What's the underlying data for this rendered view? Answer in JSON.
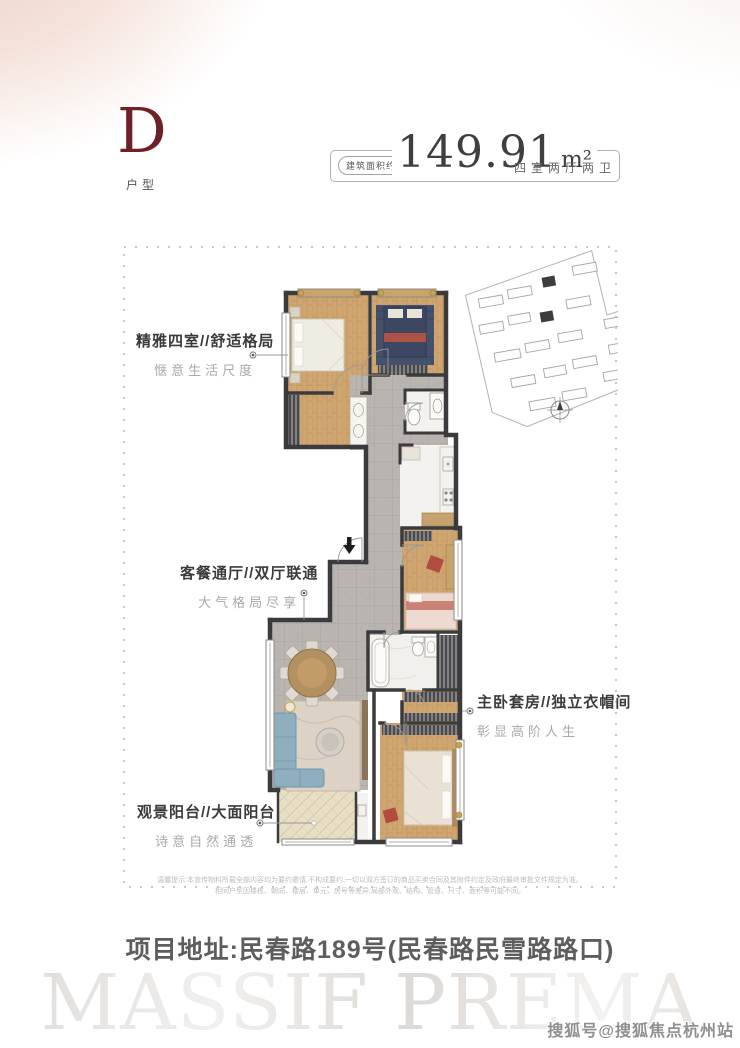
{
  "header": {
    "unit_letter": "D",
    "unit_label": "户型",
    "area_prefix": "建筑面积约",
    "area_value": "149.91",
    "area_unit": "m²",
    "room_config": "四室两厅两卫"
  },
  "callouts": [
    {
      "title": "精雅四室//舒适格局",
      "subtitle": "惬意生活尺度"
    },
    {
      "title": "客餐通厅//双厅联通",
      "subtitle": "大气格局尽享"
    },
    {
      "title": "主卧套房//独立衣帽间",
      "subtitle": "彰显高阶人生"
    },
    {
      "title": "观景阳台//大面阳台",
      "subtitle": "诗意自然通透"
    }
  ],
  "disclaimer": {
    "line1": "温馨提示:本宣传物料所载全部内容均为要约邀请,不构成要约,一切以双方签订的商品买卖合同及其附件约定及政府最终审批文件规定为准。",
    "line2": "相同户型因楼栋、朝向、楼层、单元、房号等差异,局部外观、结构、管道、尺寸、面积等可能不同。"
  },
  "address": "项目地址:民春路189号(民春路民雪路路口)",
  "watermark": "MASSIF PREMA",
  "sohu_tag": "搜狐号@搜狐焦点杭州站",
  "colors": {
    "accent_maroon": "#6d2026",
    "wall": "#3b3a3c",
    "wood_floor": "#cfa671",
    "tile_floor": "#b9b4b0",
    "balcony_floor": "#e8dfc7",
    "sofa_blue": "#8fafc0",
    "bed_navy": "#3d4763",
    "accent_red": "#b14c40",
    "gradient_peach": "#eccfc4"
  }
}
